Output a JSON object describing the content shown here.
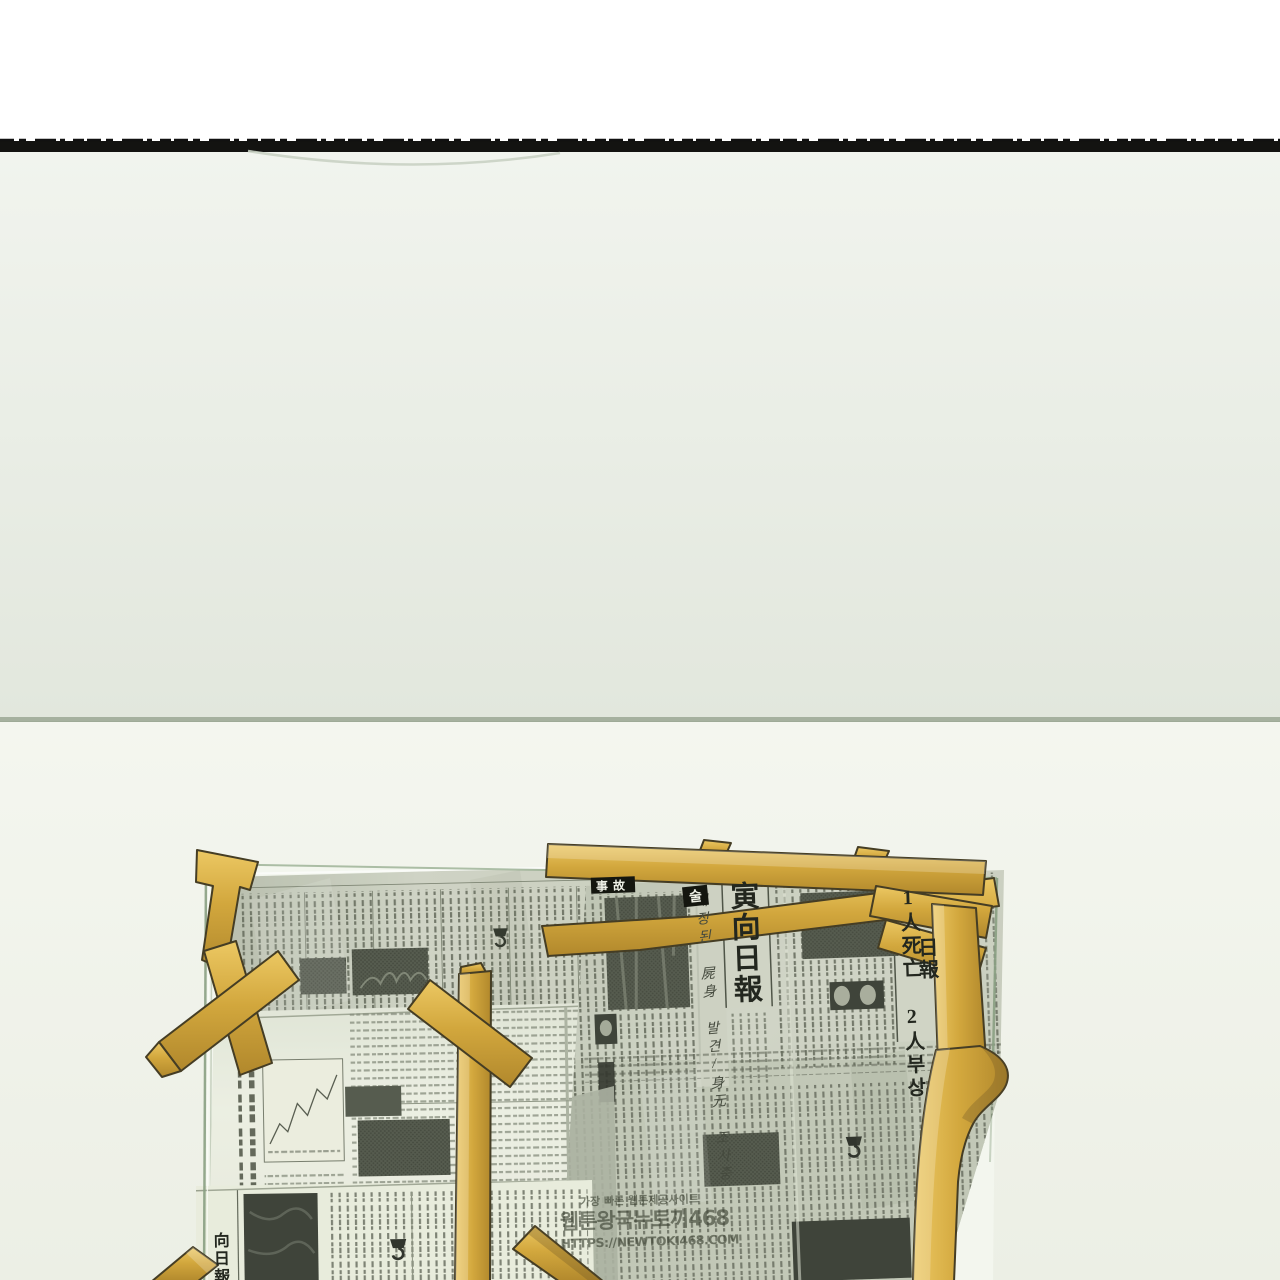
{
  "texts": {
    "masthead_right": "寅向日報",
    "byline_vertical": "매장된 屍身 발견/身元 조사중",
    "casualty_headline": "1人死亡 2人부상",
    "masthead_fragment": "日報",
    "headline_fragment_accident": "事故",
    "headline_fragment_sul": "술",
    "masthead_bottom_left": "向日報"
  },
  "watermark": {
    "line1": "가장 빠른 웹툰제공사이트",
    "line2": "웹툰왕국뉴토끼468",
    "line3": "HTTPS://NEWTOKI468.COM"
  },
  "colors": {
    "band": "#131311",
    "wall-upper": "#f1f4ee",
    "wall-upper-deep": "#e2e7dd",
    "divider": "#a6b19f",
    "wall-lower": "#f4f6ef",
    "wall-lower-deep": "#ecefe5",
    "glass": "#f5f8f1",
    "glass-edge": "#8aa083",
    "paper-a-dark": "#b2b8a7",
    "paper-a-light": "#cdd1c3",
    "paper-b": "#edf0e4",
    "paper-b-dark": "#dfe3d5",
    "paper-c-dark": "#b5bbaa",
    "paper-c-light": "#cfd3c5",
    "paper-d": "#e9ecdd",
    "ink": "#565b4d",
    "ink-soft": "#7b8172",
    "ink-dark": "#23271f",
    "photo": "#474c40",
    "photo-dark": "#2d3129",
    "tape": "#d2a73d",
    "tape-hi": "#ecc863",
    "tape-lo": "#b1882c",
    "tape-outline": "#453d24",
    "wm": "#3a4031"
  }
}
